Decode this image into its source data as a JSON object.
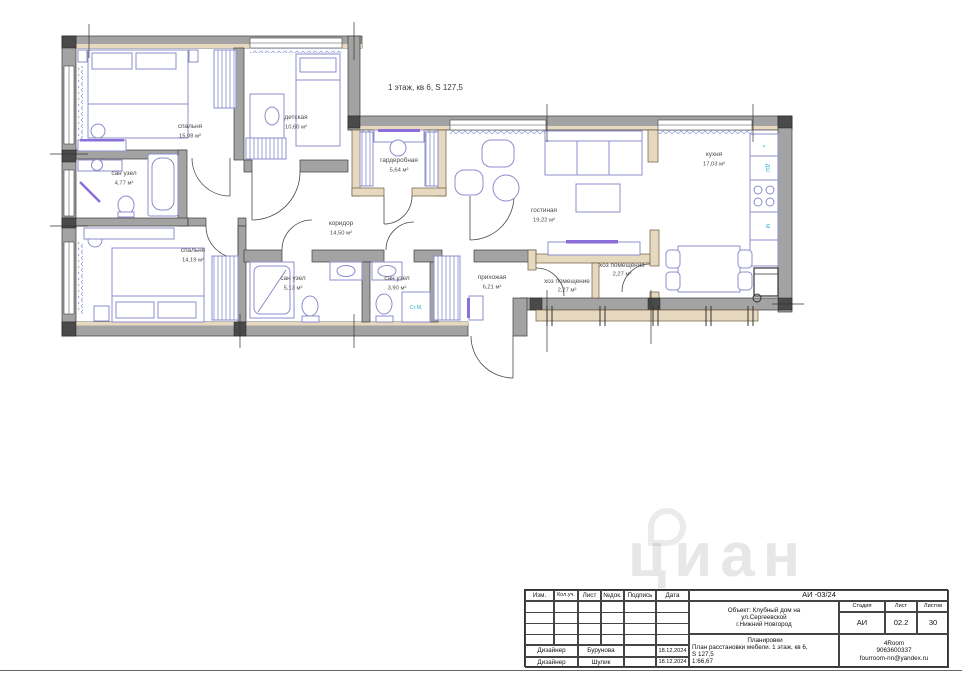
{
  "plan": {
    "note": "1 этаж, кв 6, S 127,5",
    "rooms": [
      {
        "name": "спальня",
        "area": "15,08 м²"
      },
      {
        "name": "детская",
        "area": "10,60 м²"
      },
      {
        "name": "сан узел",
        "area": "4,77 м²"
      },
      {
        "name": "гардеробная",
        "area": "5,64 м²"
      },
      {
        "name": "коридор",
        "area": "14,50 м²"
      },
      {
        "name": "гостиная",
        "area": "19,22 м²"
      },
      {
        "name": "кухня",
        "area": "17,03 м²"
      },
      {
        "name": "спальня",
        "area": "14,19 м²"
      },
      {
        "name": "сан узел",
        "area": "5,13 м²"
      },
      {
        "name": "сан узел",
        "area": "3,90 м²"
      },
      {
        "name": "прихожая",
        "area": "6,21 м²"
      },
      {
        "name": "хоз помещение",
        "area": "2,27 м²"
      },
      {
        "name": "хоз помещение",
        "area": "2,27 м²"
      }
    ],
    "labels": {
      "washer": "Ст.М.",
      "dishwasher": "ДШ",
      "microwave": "М",
      "sink_mark": "×"
    },
    "colors": {
      "furniture": "#8c8ccd",
      "accent": "#8a6fd8",
      "wall": "#a3a3a3",
      "wall_beige": "#e7d9bf",
      "appliance_label": "#2fb4c8"
    }
  },
  "titleblock": {
    "doc_code": "АИ -03/24",
    "cols": [
      "Изм.",
      "Кол.уч.",
      "Лист",
      "№док.",
      "Подпись",
      "Дата"
    ],
    "object_line1": "Объект: Клубный дом на",
    "object_line2": "ул.Сергеевской",
    "object_line3": "г.Нижний Новгород",
    "stage_label": "Стадия",
    "sheet_label": "Лист",
    "sheets_label": "Листов",
    "stage": "АИ",
    "sheet": "02.2",
    "sheets": "30",
    "section_title": "Планировки",
    "section_line1": "План расстановки мебели. 1 этаж, кв 6,",
    "section_line2": "S 127,5",
    "scale": "1:66,67",
    "company": "4Room",
    "phone": "9063600337",
    "email": "fourroom-nn@yandex.ru",
    "rows": [
      {
        "role": "Дизайнер",
        "name": "Бурунова",
        "date": "18.12.2024"
      },
      {
        "role": "Дизайнер",
        "name": "Шулик",
        "date": "18.12.2024"
      }
    ]
  },
  "watermark": "циан"
}
